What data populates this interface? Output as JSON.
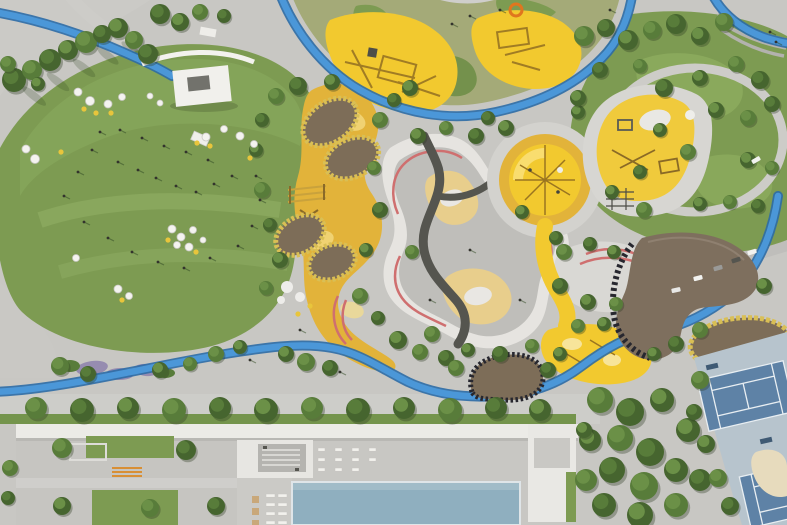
{
  "meta": {
    "description": "Top-down aerial render of a landscaped park: large green event lawn with parasols and a stage, yellow playground zones with climbing pods, a terraced maze mound with pink contour stripes, a blue cycling track looping through, a round yellow play circle, a brown kidney-shaped canopy, tennis courts, and a long white building with a swimming pool along the bottom."
  },
  "palette": {
    "base": "#c8c7c3",
    "plaza_light": "#d4d3cf",
    "path": "#cfcecb",
    "lawn": "#7d9b52",
    "lawn_light": "#8fae60",
    "lawn_dark": "#6d8c46",
    "tree_dark": "#46652f",
    "tree_mid": "#587c3a",
    "tree_light": "#6b9047",
    "olive": "#a4aa78",
    "yellow": "#f2c92f",
    "yellow_pale": "#f6df8a",
    "ochre": "#e2b33a",
    "sand": "#e8ce8c",
    "track_blue": "#4b97d8",
    "track_edge": "#2c6ca6",
    "maze_white": "#e6e4e0",
    "maze_gray": "#bfbeba",
    "pink": "#cf6f6f",
    "asphalt": "#55554f",
    "pod_brown": "#7d6d58",
    "pod_rim": "#d9bf55",
    "canopy_brown": "#7e6f5e",
    "lattice_dark": "#27272f",
    "pool": "#8fafbf",
    "tennis_base": "#b7c4cd",
    "tennis_court": "#5e82a6",
    "building_white": "#ecebe7",
    "building_gray": "#c6c5c1",
    "shrub_purple": "#968cb0",
    "orange": "#d88f35",
    "white": "#f1f0ec",
    "people": "#33332d",
    "equip_tan": "#a07c24",
    "slide_orange": "#e0761e",
    "car_colors": [
      "#f2f2f0",
      "#55554f",
      "#9a9a98",
      "#e8e8e6"
    ]
  },
  "objects": {
    "trees": [
      [
        14,
        80,
        12,
        0
      ],
      [
        32,
        70,
        10,
        1
      ],
      [
        50,
        60,
        11,
        0
      ],
      [
        68,
        50,
        10,
        2
      ],
      [
        86,
        42,
        11,
        1
      ],
      [
        102,
        34,
        9,
        0
      ],
      [
        118,
        28,
        10,
        2
      ],
      [
        134,
        40,
        9,
        1
      ],
      [
        148,
        54,
        10,
        0
      ],
      [
        38,
        84,
        7,
        2
      ],
      [
        8,
        64,
        8,
        1
      ],
      [
        160,
        14,
        10,
        0
      ],
      [
        180,
        22,
        9,
        2
      ],
      [
        200,
        12,
        8,
        1
      ],
      [
        224,
        16,
        7,
        0
      ],
      [
        276,
        96,
        8,
        1
      ],
      [
        262,
        120,
        7,
        0
      ],
      [
        256,
        150,
        7,
        2
      ],
      [
        262,
        190,
        8,
        1
      ],
      [
        270,
        225,
        7,
        0
      ],
      [
        280,
        260,
        8,
        2
      ],
      [
        266,
        288,
        7,
        1
      ],
      [
        298,
        86,
        9,
        0
      ],
      [
        332,
        82,
        8,
        2
      ],
      [
        380,
        120,
        8,
        1
      ],
      [
        394,
        100,
        7,
        0
      ],
      [
        410,
        88,
        8,
        2
      ],
      [
        374,
        168,
        7,
        1
      ],
      [
        380,
        210,
        8,
        0
      ],
      [
        366,
        250,
        7,
        2
      ],
      [
        360,
        296,
        8,
        1
      ],
      [
        378,
        318,
        7,
        0
      ],
      [
        398,
        340,
        9,
        2
      ],
      [
        420,
        352,
        8,
        1
      ],
      [
        446,
        358,
        8,
        0
      ],
      [
        418,
        136,
        8,
        2
      ],
      [
        446,
        128,
        7,
        1
      ],
      [
        476,
        136,
        8,
        0
      ],
      [
        412,
        252,
        7,
        1
      ],
      [
        522,
        212,
        7,
        2
      ],
      [
        556,
        238,
        7,
        0
      ],
      [
        432,
        334,
        8,
        1
      ],
      [
        468,
        350,
        7,
        2
      ],
      [
        500,
        354,
        8,
        0
      ],
      [
        532,
        346,
        7,
        1
      ],
      [
        506,
        128,
        8,
        2
      ],
      [
        488,
        118,
        7,
        0
      ],
      [
        578,
        112,
        7,
        2
      ],
      [
        584,
        36,
        10,
        1
      ],
      [
        606,
        28,
        9,
        0
      ],
      [
        628,
        40,
        10,
        2
      ],
      [
        652,
        30,
        9,
        1
      ],
      [
        676,
        24,
        10,
        0
      ],
      [
        700,
        36,
        9,
        2
      ],
      [
        724,
        22,
        9,
        1
      ],
      [
        600,
        70,
        8,
        0
      ],
      [
        578,
        98,
        8,
        2
      ],
      [
        640,
        66,
        7,
        1
      ],
      [
        664,
        88,
        9,
        0
      ],
      [
        700,
        78,
        8,
        2
      ],
      [
        736,
        64,
        8,
        1
      ],
      [
        760,
        80,
        9,
        0
      ],
      [
        716,
        110,
        8,
        2
      ],
      [
        748,
        118,
        8,
        1
      ],
      [
        772,
        104,
        8,
        0
      ],
      [
        660,
        130,
        7,
        2
      ],
      [
        688,
        152,
        8,
        1
      ],
      [
        748,
        160,
        8,
        2
      ],
      [
        772,
        168,
        7,
        1
      ],
      [
        640,
        172,
        7,
        0
      ],
      [
        612,
        192,
        7,
        2
      ],
      [
        644,
        210,
        8,
        1
      ],
      [
        700,
        204,
        7,
        2
      ],
      [
        730,
        202,
        7,
        1
      ],
      [
        758,
        206,
        7,
        0
      ],
      [
        564,
        252,
        8,
        1
      ],
      [
        590,
        244,
        7,
        0
      ],
      [
        614,
        252,
        7,
        2
      ],
      [
        560,
        286,
        8,
        0
      ],
      [
        588,
        302,
        8,
        2
      ],
      [
        616,
        304,
        7,
        1
      ],
      [
        604,
        324,
        7,
        2
      ],
      [
        578,
        326,
        7,
        1
      ],
      [
        764,
        286,
        8,
        2
      ],
      [
        700,
        330,
        8,
        1
      ],
      [
        676,
        344,
        8,
        0
      ],
      [
        654,
        354,
        7,
        2
      ],
      [
        286,
        354,
        8,
        2
      ],
      [
        306,
        362,
        9,
        1
      ],
      [
        330,
        368,
        8,
        0
      ],
      [
        240,
        347,
        7,
        2
      ],
      [
        216,
        354,
        8,
        1
      ],
      [
        60,
        366,
        9,
        1
      ],
      [
        88,
        374,
        8,
        0
      ],
      [
        160,
        370,
        8,
        2
      ],
      [
        190,
        364,
        7,
        1
      ],
      [
        456,
        368,
        8,
        1
      ],
      [
        548,
        370,
        8,
        0
      ],
      [
        560,
        354,
        7,
        2
      ],
      [
        36,
        408,
        11,
        1
      ],
      [
        82,
        410,
        12,
        0
      ],
      [
        128,
        408,
        11,
        2
      ],
      [
        174,
        410,
        12,
        1
      ],
      [
        220,
        408,
        11,
        0
      ],
      [
        266,
        410,
        12,
        2
      ],
      [
        312,
        408,
        11,
        1
      ],
      [
        358,
        410,
        12,
        0
      ],
      [
        404,
        408,
        11,
        2
      ],
      [
        450,
        410,
        12,
        1
      ],
      [
        496,
        408,
        11,
        0
      ],
      [
        540,
        410,
        11,
        2
      ],
      [
        600,
        400,
        13,
        1
      ],
      [
        630,
        412,
        14,
        0
      ],
      [
        662,
        400,
        12,
        2
      ],
      [
        620,
        438,
        13,
        1
      ],
      [
        650,
        452,
        14,
        0
      ],
      [
        688,
        430,
        12,
        2
      ],
      [
        612,
        470,
        13,
        0
      ],
      [
        644,
        486,
        14,
        1
      ],
      [
        676,
        470,
        12,
        2
      ],
      [
        604,
        505,
        12,
        0
      ],
      [
        640,
        515,
        13,
        2
      ],
      [
        676,
        505,
        12,
        1
      ],
      [
        700,
        480,
        11,
        0
      ],
      [
        590,
        440,
        11,
        2
      ],
      [
        586,
        480,
        11,
        1
      ],
      [
        700,
        380,
        9,
        1
      ],
      [
        694,
        412,
        8,
        0
      ],
      [
        706,
        444,
        9,
        2
      ],
      [
        718,
        478,
        9,
        1
      ],
      [
        730,
        506,
        9,
        0
      ],
      [
        62,
        448,
        10,
        1
      ],
      [
        186,
        450,
        10,
        0
      ],
      [
        62,
        506,
        9,
        2
      ],
      [
        150,
        508,
        9,
        1
      ],
      [
        216,
        506,
        9,
        0
      ],
      [
        10,
        468,
        8,
        1
      ],
      [
        8,
        498,
        7,
        0
      ],
      [
        584,
        430,
        8,
        2
      ]
    ],
    "umbrellas_white": [
      [
        78,
        92,
        4
      ],
      [
        90,
        101,
        4.5
      ],
      [
        108,
        104,
        4
      ],
      [
        122,
        97,
        3.5
      ],
      [
        26,
        149,
        4
      ],
      [
        35,
        159,
        4.5
      ],
      [
        206,
        137,
        4
      ],
      [
        224,
        129,
        3.5
      ],
      [
        240,
        136,
        4
      ],
      [
        254,
        144,
        3.5
      ],
      [
        150,
        96,
        3
      ],
      [
        160,
        103,
        3
      ],
      [
        172,
        229,
        4
      ],
      [
        181,
        237,
        4
      ],
      [
        193,
        230,
        3.5
      ],
      [
        177,
        245,
        3.5
      ],
      [
        189,
        247,
        4
      ],
      [
        118,
        289,
        4
      ],
      [
        129,
        296,
        3.5
      ],
      [
        76,
        258,
        3.5
      ],
      [
        203,
        240,
        3
      ]
    ],
    "dots_yellow": [
      [
        84,
        109
      ],
      [
        96,
        113
      ],
      [
        111,
        113
      ],
      [
        61,
        152
      ],
      [
        250,
        158
      ],
      [
        197,
        143
      ],
      [
        168,
        240
      ],
      [
        196,
        252
      ],
      [
        122,
        300
      ],
      [
        210,
        146
      ],
      [
        310,
        306
      ],
      [
        298,
        314
      ]
    ],
    "people": [
      [
        92,
        150
      ],
      [
        118,
        162
      ],
      [
        138,
        170
      ],
      [
        156,
        178
      ],
      [
        176,
        186
      ],
      [
        196,
        192
      ],
      [
        214,
        184
      ],
      [
        232,
        176
      ],
      [
        208,
        160
      ],
      [
        186,
        152
      ],
      [
        164,
        146
      ],
      [
        142,
        138
      ],
      [
        120,
        130
      ],
      [
        100,
        132
      ],
      [
        78,
        172
      ],
      [
        64,
        196
      ],
      [
        84,
        222
      ],
      [
        108,
        238
      ],
      [
        132,
        252
      ],
      [
        158,
        262
      ],
      [
        184,
        268
      ],
      [
        210,
        258
      ],
      [
        238,
        246
      ],
      [
        252,
        226
      ],
      [
        260,
        200
      ],
      [
        256,
        176
      ],
      [
        470,
        16
      ],
      [
        500,
        10
      ],
      [
        452,
        24
      ],
      [
        610,
        10
      ],
      [
        770,
        32
      ],
      [
        776,
        42
      ],
      [
        340,
        372
      ],
      [
        250,
        360
      ],
      [
        300,
        330
      ],
      [
        520,
        300
      ],
      [
        470,
        250
      ],
      [
        430,
        300
      ]
    ],
    "cars": [
      [
        752,
        252,
        -18,
        0
      ],
      [
        736,
        260,
        -18,
        1
      ],
      [
        718,
        268,
        -16,
        2
      ],
      [
        698,
        278,
        -14,
        0
      ],
      [
        676,
        290,
        -12,
        3
      ],
      [
        756,
        160,
        -30,
        0
      ]
    ],
    "loungers": [
      [
        318,
        448
      ],
      [
        335,
        448
      ],
      [
        352,
        448
      ],
      [
        369,
        448
      ],
      [
        318,
        458
      ],
      [
        335,
        458
      ],
      [
        352,
        458
      ],
      [
        369,
        458
      ],
      [
        318,
        468
      ],
      [
        335,
        468
      ],
      [
        352,
        468
      ]
    ],
    "pool_loungers": [
      [
        266,
        494
      ],
      [
        278,
        494
      ],
      [
        266,
        503
      ],
      [
        278,
        503
      ],
      [
        266,
        512
      ],
      [
        278,
        512
      ],
      [
        266,
        521
      ],
      [
        278,
        521
      ]
    ],
    "parasols": [
      [
        252,
        496
      ],
      [
        252,
        508
      ],
      [
        252,
        520
      ]
    ]
  }
}
